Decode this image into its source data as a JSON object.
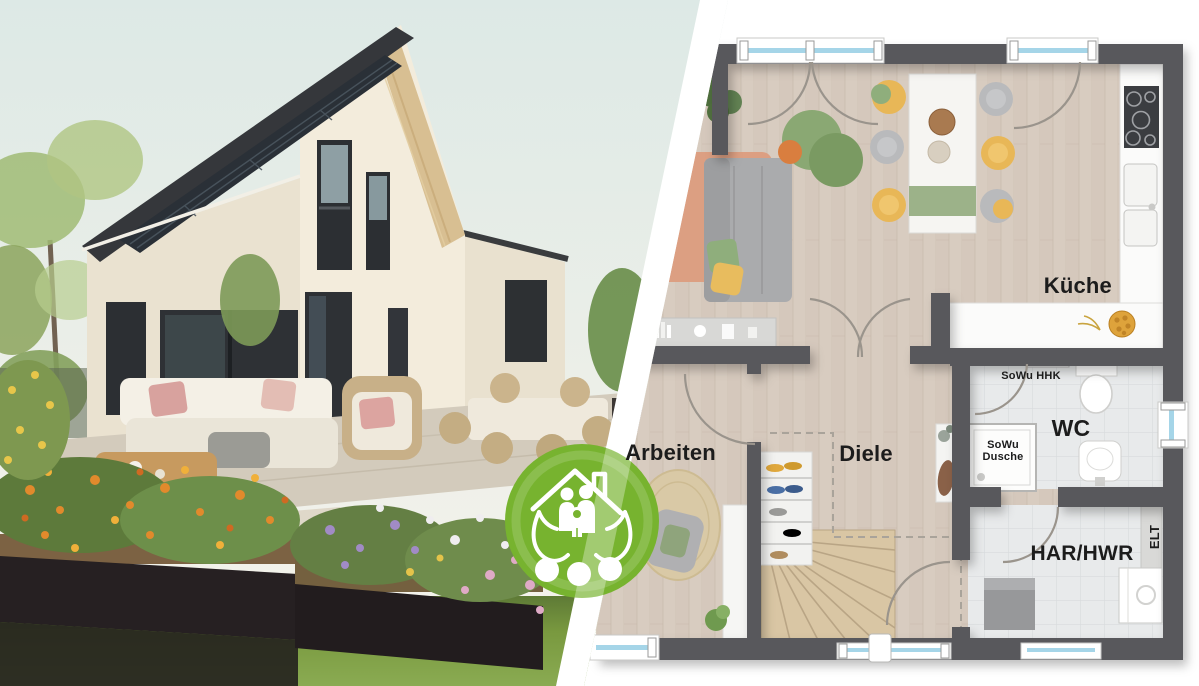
{
  "floorplan": {
    "labels": {
      "kueche": "Küche",
      "wc": "WC",
      "sowu_hhk": "SoWu HHK",
      "sowu_dusche": "SoWu Dusche",
      "arbeiten": "Arbeiten",
      "diele": "Diele",
      "har_hwr": "HAR/HWR",
      "elt": "ELT"
    }
  },
  "badge": {
    "icon": "family-house-in-hands-icon"
  },
  "colors": {
    "green": "#77b32f",
    "wallGray": "#59595c",
    "wood": "#d8ccc0",
    "tile": "#e8eaeb",
    "glassBlue": "#a5d5e8",
    "chairYellow": "#e8b757",
    "chairGray": "#b9babc",
    "textileGreen": "#93af7e",
    "rugOrange": "#dc9f82",
    "stairWood": "#d9c6a4",
    "labelColor": "#1c1c1c",
    "sky": "#e2ebe7",
    "roofDark": "#35373b",
    "lawnGreen": "#7fa04a"
  }
}
